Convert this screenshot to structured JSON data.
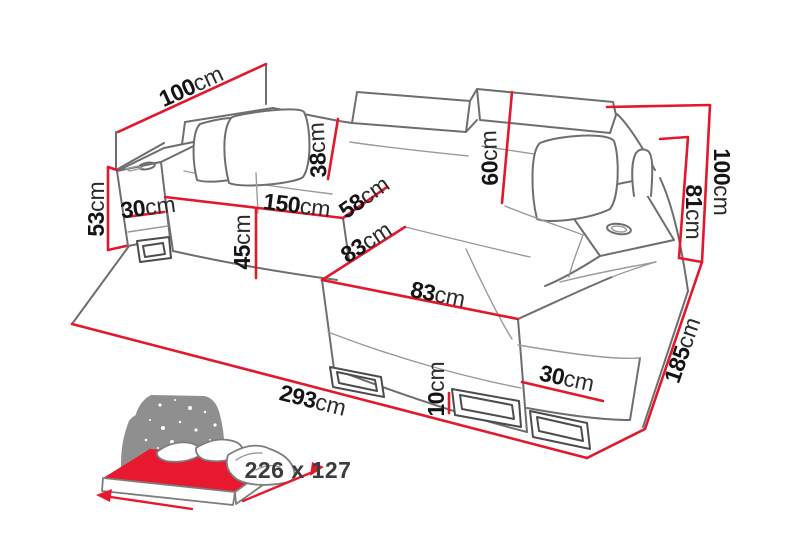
{
  "title": "Corner sofa bed dimensions diagram",
  "colors": {
    "dimension_red": "#e2182c",
    "outline_gray": "#6e6e6e",
    "label_black": "#141414",
    "bed_headboard_gray": "#8f8f8f",
    "bed_mattress_red": "#e8192e",
    "bed_text_gray": "#3c3c3c"
  },
  "dimensions": {
    "depth_back_left": {
      "value": "100",
      "unit": "cm"
    },
    "armrest_left_height": {
      "value": "53",
      "unit": "cm"
    },
    "armrest_left_width": {
      "value": "30",
      "unit": "cm"
    },
    "seat_width": {
      "value": "150",
      "unit": "cm"
    },
    "seat_depth": {
      "value": "58",
      "unit": "cm"
    },
    "backrest_left_height": {
      "value": "38",
      "unit": "cm"
    },
    "backrest_right_height": {
      "value": "60",
      "unit": "cm"
    },
    "seat_height": {
      "value": "45",
      "unit": "cm"
    },
    "chaise_extension": {
      "value": "83",
      "unit": "cm"
    },
    "chaise_width": {
      "value": "83",
      "unit": "cm"
    },
    "total_height": {
      "value": "100",
      "unit": "cm"
    },
    "armrest_right_height": {
      "value": "81",
      "unit": "cm"
    },
    "total_depth": {
      "value": "185",
      "unit": "cm"
    },
    "base_right_width": {
      "value": "30",
      "unit": "cm"
    },
    "leg_height": {
      "value": "10",
      "unit": "cm"
    },
    "total_width": {
      "value": "293",
      "unit": "cm"
    }
  },
  "sleeping_area": {
    "size": "226 x 127"
  }
}
